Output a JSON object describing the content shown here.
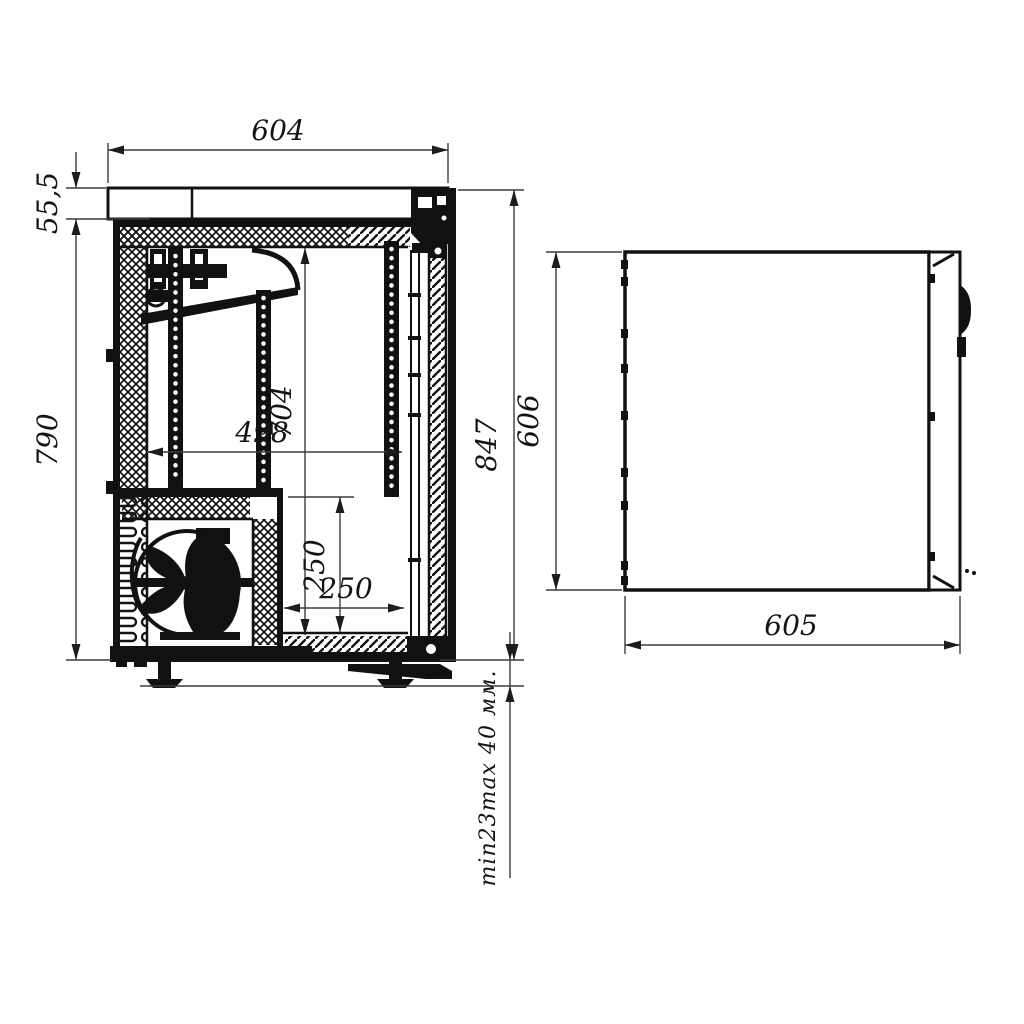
{
  "colors": {
    "ink": "#111111",
    "dimension_line": "#3c3c3c",
    "background": "#ffffff"
  },
  "side_view": {
    "description": "side cross-section of cabinet",
    "dimensions": {
      "top_width": "604",
      "worktop_height": "55,5",
      "body_height": "790",
      "overall_height": "847",
      "interior_height": "704",
      "interior_depth": "498",
      "machine_bay_height": "250",
      "machine_bay_depth": "250",
      "feet_range": "min23max 40 мм."
    }
  },
  "plan_view": {
    "description": "top plan view of cabinet",
    "dimensions": {
      "depth": "606",
      "width": "605"
    }
  }
}
